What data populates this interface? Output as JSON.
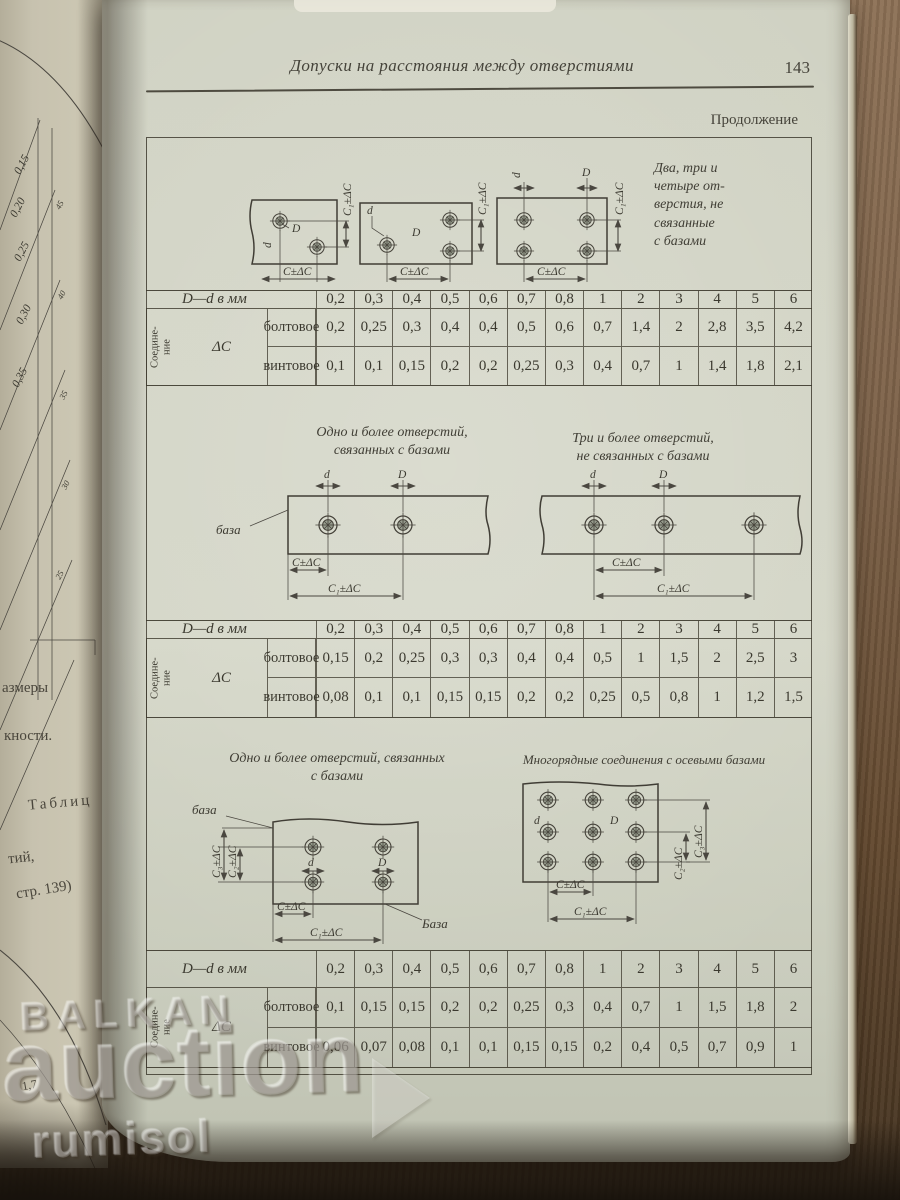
{
  "page": {
    "running_title": "Допуски на расстояния между отверстиями",
    "page_number": "143",
    "continuation": "Продолжение"
  },
  "labels": {
    "dim_c": "C±ΔC",
    "dim_c1": "C₁±ΔC",
    "dim_c2": "C₂±ΔC",
    "dim_c3": "C₃±ΔC",
    "d": "d",
    "D": "D",
    "base": "база",
    "base_cap": "База",
    "delta": "ΔC"
  },
  "sections": {
    "s1": {
      "caption": "Два, три и\nчетыре от-\nверстия, не\nсвязанные\nс базами"
    },
    "s2": {
      "caption_left": "Одно и более отверстий,\nсвязанных с базами",
      "caption_right": "Три и более отверстий,\nне связанных с базами"
    },
    "s3": {
      "caption_left": "Одно и более отверстий, связанных\nс базами",
      "caption_right": "Многорядные соединения с осевыми базами"
    }
  },
  "table_common": {
    "header_label": "D—d в мм",
    "group_label": "Соедине-\nние",
    "row_bolt": "болтовое",
    "row_vint": "винтовое",
    "columns": [
      "0,2",
      "0,3",
      "0,4",
      "0,5",
      "0,6",
      "0,7",
      "0,8",
      "1",
      "2",
      "3",
      "4",
      "5",
      "6"
    ]
  },
  "tables": {
    "t1": {
      "bolt": [
        "0,2",
        "0,25",
        "0,3",
        "0,4",
        "0,4",
        "0,5",
        "0,6",
        "0,7",
        "1,4",
        "2",
        "2,8",
        "3,5",
        "4,2"
      ],
      "vint": [
        "0,1",
        "0,1",
        "0,15",
        "0,2",
        "0,2",
        "0,25",
        "0,3",
        "0,4",
        "0,7",
        "1",
        "1,4",
        "1,8",
        "2,1"
      ]
    },
    "t2": {
      "bolt": [
        "0,15",
        "0,2",
        "0,25",
        "0,3",
        "0,3",
        "0,4",
        "0,4",
        "0,5",
        "1",
        "1,5",
        "2",
        "2,5",
        "3"
      ],
      "vint": [
        "0,08",
        "0,1",
        "0,1",
        "0,15",
        "0,15",
        "0,2",
        "0,2",
        "0,25",
        "0,5",
        "0,8",
        "1",
        "1,2",
        "1,5"
      ]
    },
    "t3": {
      "bolt": [
        "0,1",
        "0,15",
        "0,15",
        "0,2",
        "0,2",
        "0,25",
        "0,3",
        "0,4",
        "0,7",
        "1",
        "1,5",
        "1,8",
        "2"
      ],
      "vint": [
        "0,06",
        "0,07",
        "0,08",
        "0,1",
        "0,1",
        "0,15",
        "0,15",
        "0,2",
        "0,4",
        "0,5",
        "0,7",
        "0,9",
        "1"
      ]
    }
  },
  "left_page": {
    "f1": "азмеры",
    "f2": "кности.",
    "f3": "Таблиц",
    "f4": "тий,",
    "f5": "стр. 139)",
    "f6": "1,7",
    "ticks": [
      "0,15",
      "0,20",
      "0,25",
      "0,30",
      "0,35"
    ],
    "small_ticks": [
      "45",
      "40",
      "35",
      "30",
      "25"
    ]
  },
  "watermark": {
    "line1": "BALKAN",
    "line2": "auction",
    "line3": "rumisol"
  },
  "colors": {
    "paper": "#d3d5c6",
    "ink": "#3c3a31",
    "wood": "#7d6249"
  }
}
